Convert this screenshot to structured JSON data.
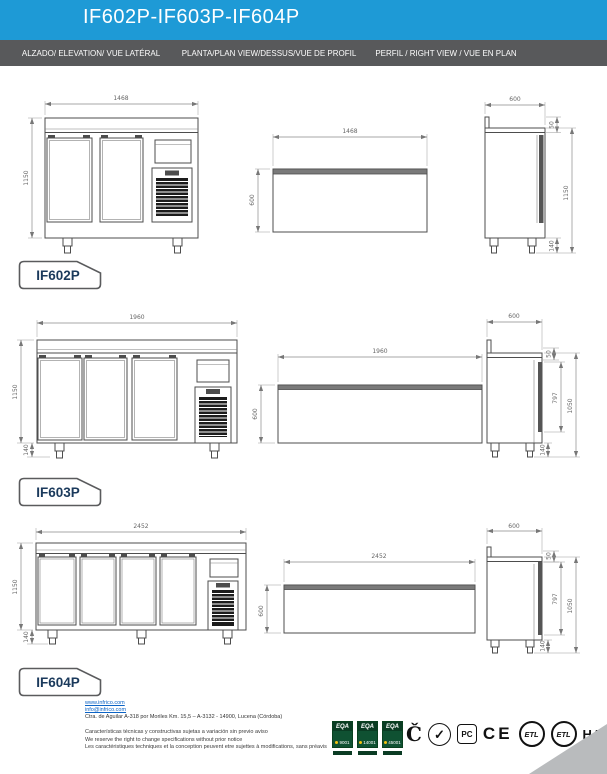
{
  "header": {
    "title": "IF602P-IF603P-IF604P",
    "bg_color": "#1e9ad6",
    "bar_color": "#58595b"
  },
  "columns": [
    {
      "label": "ALZADO/ ELEVATION/ VUE LATÉRAL"
    },
    {
      "label": "PLANTA/PLAN VIEW/DESSUS/VUE DE PROFIL"
    },
    {
      "label": "PERFIL / RIGHT VIEW / VUE EN PLAN"
    }
  ],
  "models": [
    {
      "name": "IF602P",
      "doors": 2,
      "front": {
        "width": "1468",
        "height": "1150"
      },
      "plan": {
        "width": "1468",
        "depth": "600"
      },
      "side": {
        "depth": "600",
        "splash": "50",
        "height": "1150",
        "legs": "140"
      }
    },
    {
      "name": "IF603P",
      "doors": 3,
      "front": {
        "width": "1960",
        "height": "1150",
        "legs": "140"
      },
      "plan": {
        "width": "1960",
        "depth": "600"
      },
      "side": {
        "depth": "600",
        "splash": "50",
        "door": "797",
        "height": "1050",
        "legs": "140"
      }
    },
    {
      "name": "IF604P",
      "doors": 4,
      "front": {
        "width": "2452",
        "height": "1150",
        "legs": "140"
      },
      "plan": {
        "width": "2452",
        "depth": "600"
      },
      "side": {
        "depth": "600",
        "splash": "50",
        "door": "797",
        "height": "1050",
        "legs": "140"
      }
    }
  ],
  "footer": {
    "website": "www.infrico.com",
    "email": "info@infrico.com",
    "address": "Ctra. de Aguilar A-318 por Moriles Km. 15,5 – A-3132 - 14900, Lucena (Córdoba)",
    "notes": [
      "Características técnicas y constructivas sujetas a variación sin previo aviso",
      "We reserve the right to change specifications without prior notice",
      "Les caractéristiques techniques et la conception peuvent etre sujettes à modifications, sans préavis"
    ],
    "iso": {
      "org": "EQA",
      "numbers": [
        "9001",
        "14001",
        "45001"
      ]
    },
    "marks": {
      "quality_glyph": "Č",
      "check_glyph": "✓",
      "pct_label": "PC",
      "ce_label": "CE",
      "etl_label": "ETL",
      "haccp_label": "HACCP"
    },
    "corner_color": "#b9bbbd"
  }
}
